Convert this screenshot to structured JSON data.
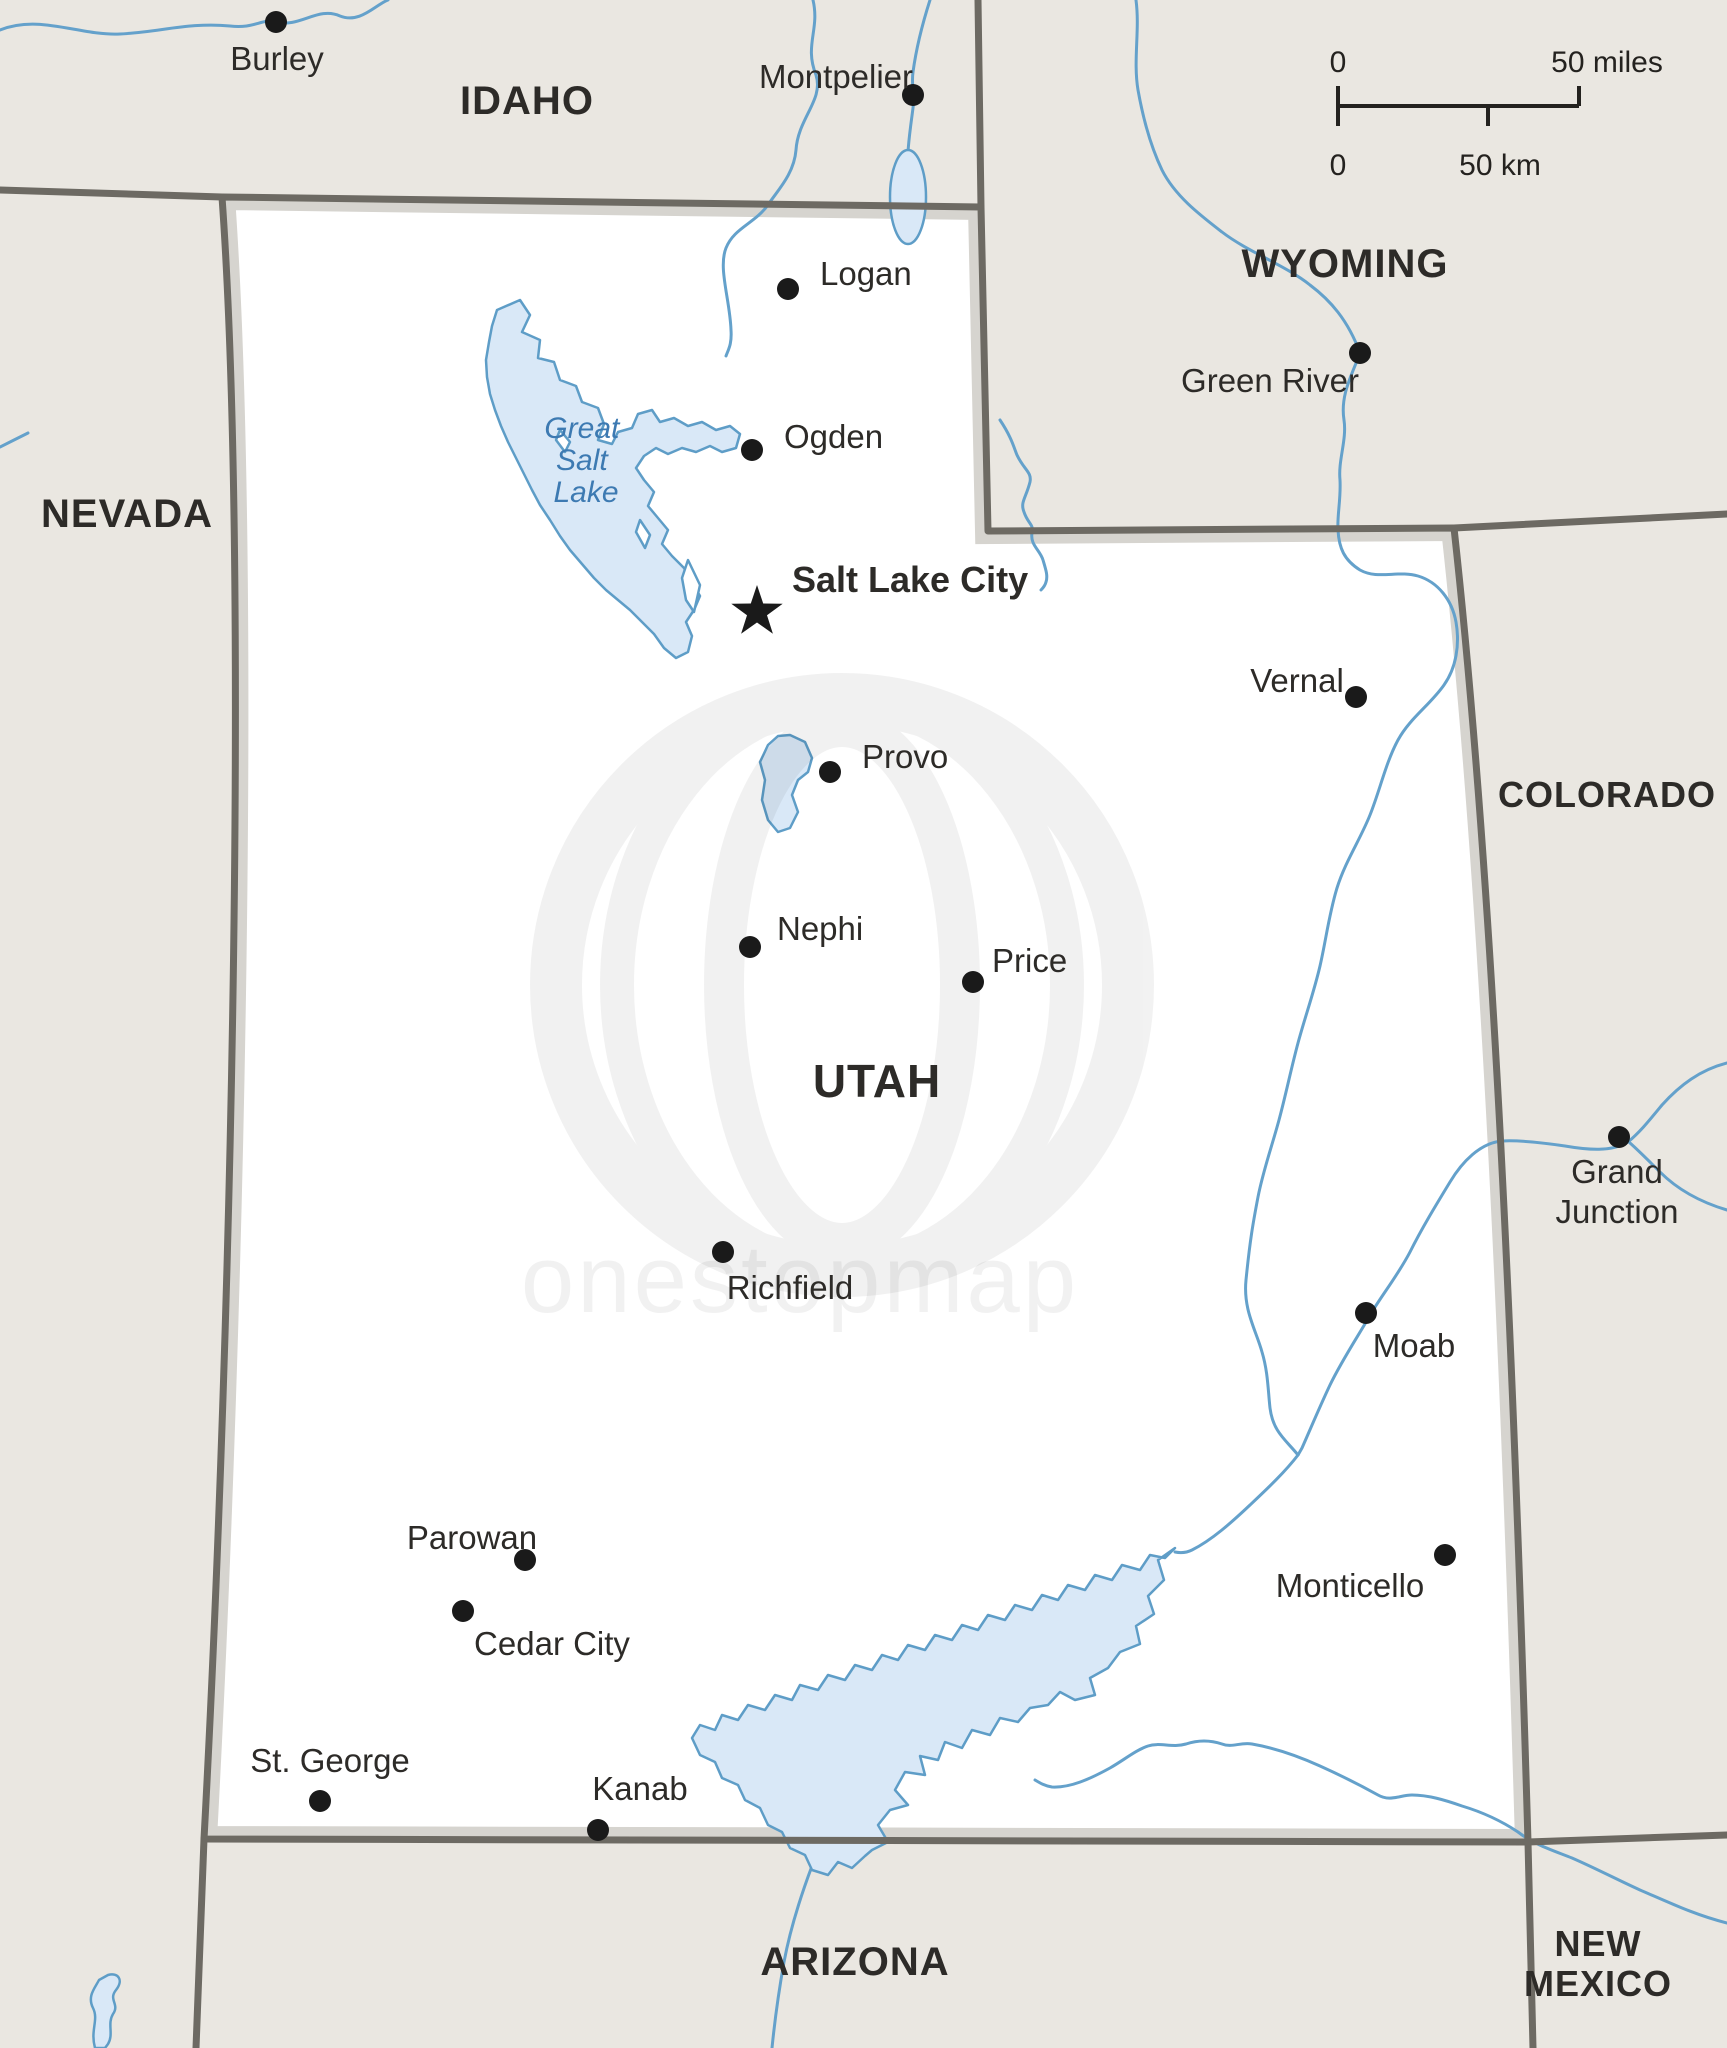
{
  "map_title": "Utah political map",
  "colors": {
    "background": "#eae7e1",
    "utah_fill": "#ffffff",
    "border_dark": "#6d6a63",
    "border_bevel": "#d6d4cf",
    "river": "#64a1cb",
    "lake_fill": "#d9e8f7",
    "lake_stroke": "#5e9dc7",
    "marker": "#1a1a1a",
    "label_text": "#2d2b28",
    "lake_text": "#3d7ab2"
  },
  "scale_bar": {
    "miles_zero": "0",
    "miles_label": "50 miles",
    "km_zero": "0",
    "km_label": "50 km"
  },
  "watermark": {
    "text": "onestopmap"
  },
  "lake_label": {
    "lines": [
      "Great",
      "Salt",
      "Lake"
    ]
  },
  "states": [
    {
      "id": "idaho",
      "lines": [
        "IDAHO"
      ],
      "x": 527,
      "y": 114,
      "size": 40
    },
    {
      "id": "nevada",
      "lines": [
        "NEVADA"
      ],
      "x": 127,
      "y": 527,
      "size": 40
    },
    {
      "id": "wyoming",
      "lines": [
        "WYOMING"
      ],
      "x": 1345,
      "y": 277,
      "size": 40
    },
    {
      "id": "colorado",
      "lines": [
        "COLORADO"
      ],
      "x": 1607,
      "y": 807,
      "size": 36
    },
    {
      "id": "utah",
      "lines": [
        "UTAH"
      ],
      "x": 877,
      "y": 1097,
      "size": 46
    },
    {
      "id": "arizona",
      "lines": [
        "ARIZONA"
      ],
      "x": 855,
      "y": 1975,
      "size": 40
    },
    {
      "id": "new-mexico",
      "lines": [
        "NEW",
        "MEXICO"
      ],
      "x": 1598,
      "y": 1956,
      "size": 36
    }
  ],
  "cities": [
    {
      "name": "Burley",
      "marker": "dot",
      "x": 276,
      "y": 22,
      "label": {
        "x": 277,
        "y": 70,
        "anchor": "middle"
      }
    },
    {
      "name": "Montpelier",
      "marker": "dot",
      "x": 913,
      "y": 95,
      "label": {
        "x": 836,
        "y": 88,
        "anchor": "middle"
      }
    },
    {
      "name": "Logan",
      "marker": "dot",
      "x": 788,
      "y": 289,
      "label": {
        "x": 820,
        "y": 285,
        "anchor": "start"
      }
    },
    {
      "name": "Ogden",
      "marker": "dot",
      "x": 752,
      "y": 450,
      "label": {
        "x": 784,
        "y": 448,
        "anchor": "start"
      }
    },
    {
      "name": "Salt Lake City",
      "marker": "star",
      "x": 757,
      "y": 612,
      "label": {
        "x": 792,
        "y": 592,
        "anchor": "start",
        "bold": true
      }
    },
    {
      "name": "Green River",
      "marker": "dot",
      "x": 1360,
      "y": 353,
      "label": {
        "x": 1270,
        "y": 392,
        "anchor": "middle"
      }
    },
    {
      "name": "Vernal",
      "marker": "dot",
      "x": 1356,
      "y": 697,
      "label": {
        "x": 1297,
        "y": 692,
        "anchor": "middle"
      }
    },
    {
      "name": "Provo",
      "marker": "dot",
      "x": 830,
      "y": 772,
      "label": {
        "x": 862,
        "y": 768,
        "anchor": "start"
      }
    },
    {
      "name": "Nephi",
      "marker": "dot",
      "x": 750,
      "y": 947,
      "label": {
        "x": 777,
        "y": 940,
        "anchor": "start"
      }
    },
    {
      "name": "Price",
      "marker": "dot",
      "x": 973,
      "y": 982,
      "label": {
        "x": 992,
        "y": 972,
        "anchor": "start"
      }
    },
    {
      "name": "Richfield",
      "marker": "dot",
      "x": 723,
      "y": 1252,
      "label": {
        "x": 790,
        "y": 1299,
        "anchor": "middle"
      }
    },
    {
      "name": "Grand Junction",
      "marker": "dot",
      "x": 1619,
      "y": 1137,
      "label": {
        "x": 1617,
        "y": 1183,
        "anchor": "middle",
        "lines": [
          "Grand",
          "Junction"
        ]
      }
    },
    {
      "name": "Moab",
      "marker": "dot",
      "x": 1366,
      "y": 1313,
      "label": {
        "x": 1414,
        "y": 1357,
        "anchor": "middle"
      }
    },
    {
      "name": "Monticello",
      "marker": "dot",
      "x": 1445,
      "y": 1555,
      "label": {
        "x": 1350,
        "y": 1597,
        "anchor": "middle"
      }
    },
    {
      "name": "Parowan",
      "marker": "dot",
      "x": 525,
      "y": 1560,
      "label": {
        "x": 472,
        "y": 1549,
        "anchor": "middle"
      }
    },
    {
      "name": "Cedar City",
      "marker": "dot",
      "x": 463,
      "y": 1611,
      "label": {
        "x": 552,
        "y": 1655,
        "anchor": "middle"
      }
    },
    {
      "name": "St. George",
      "marker": "dot",
      "x": 320,
      "y": 1801,
      "label": {
        "x": 330,
        "y": 1772,
        "anchor": "middle"
      }
    },
    {
      "name": "Kanab",
      "marker": "dot",
      "x": 598,
      "y": 1830,
      "label": {
        "x": 640,
        "y": 1800,
        "anchor": "middle"
      }
    }
  ]
}
